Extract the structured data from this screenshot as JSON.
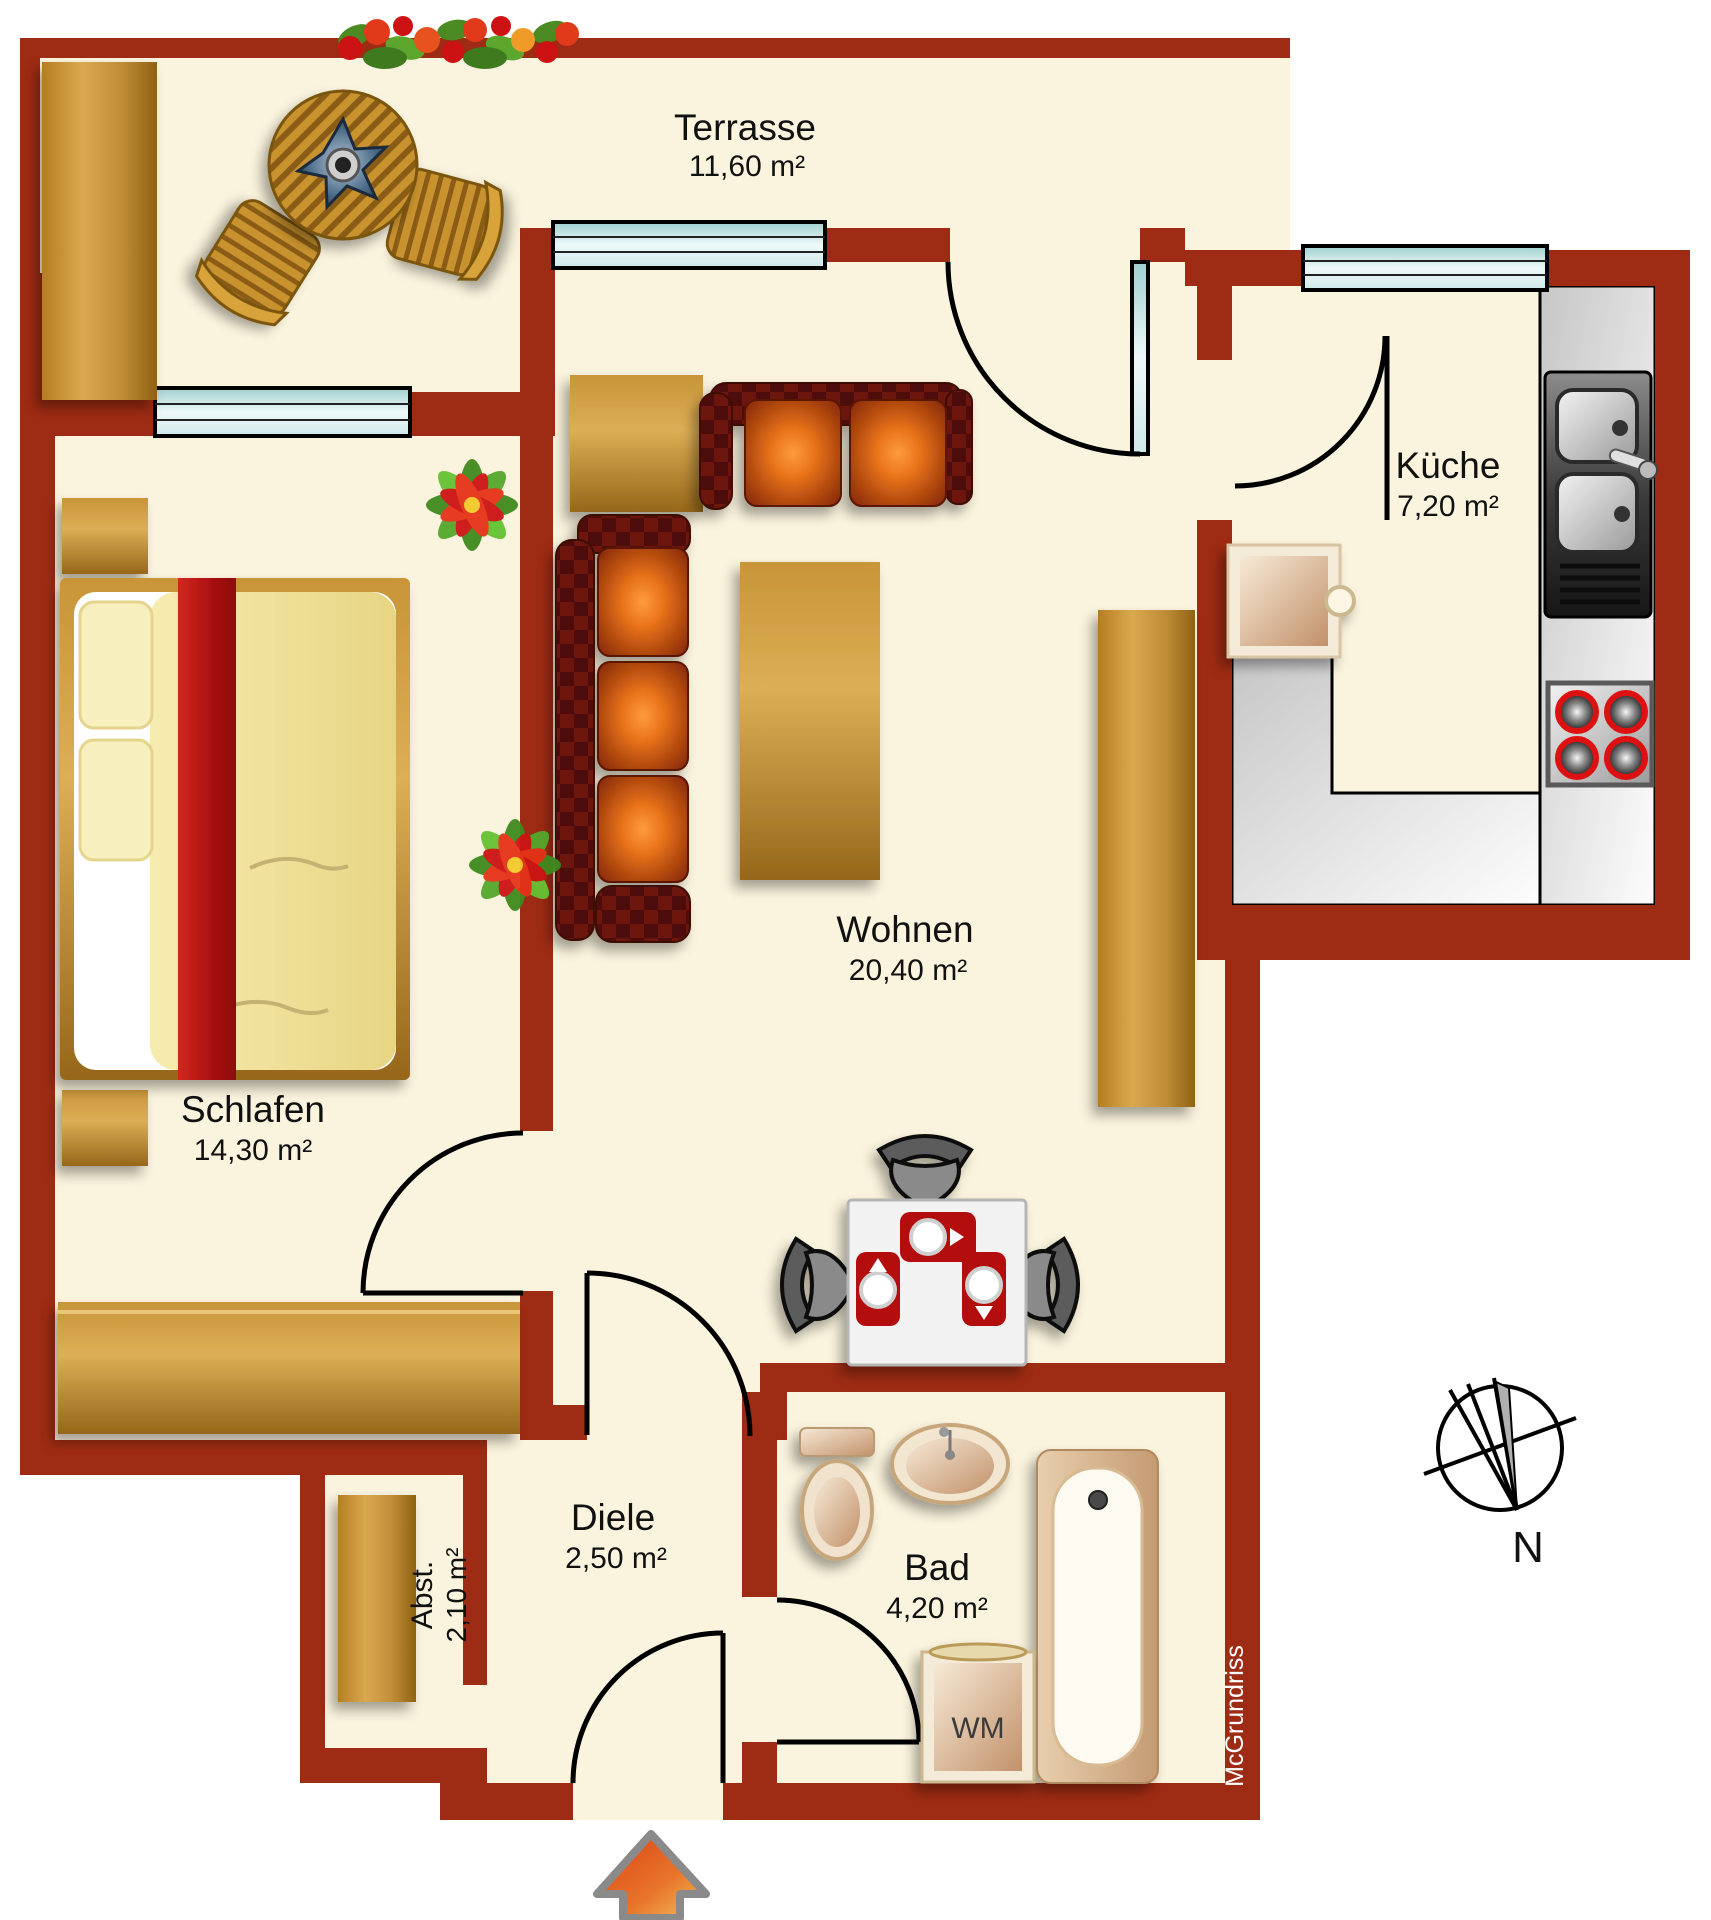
{
  "rooms": {
    "terrasse": {
      "name": "Terrasse",
      "area": "11,60 m²"
    },
    "kueche": {
      "name": "Küche",
      "area": "7,20 m²"
    },
    "wohnen": {
      "name": "Wohnen",
      "area": "20,40 m²"
    },
    "schlafen": {
      "name": "Schlafen",
      "area": "14,30 m²"
    },
    "diele": {
      "name": "Diele",
      "area": "2,50 m²"
    },
    "bad": {
      "name": "Bad",
      "area": "4,20 m²"
    },
    "abstellraum": {
      "name": "Abst.",
      "area": "2,10 m²"
    }
  },
  "appliances": {
    "washing_machine": "WM"
  },
  "compass": {
    "north": "N"
  },
  "watermark": "McGrundriss",
  "colors": {
    "wall": "#9e2b13",
    "floor": "#faf3dd",
    "background": "#ffffff",
    "wood": "#c08c36",
    "sofa_dark": "#6d150c",
    "cushion_orange": "#e9731a",
    "accent_red": "#c01818",
    "counter_gray": "#d9d9d9",
    "window_glass": "#bfe0df"
  }
}
